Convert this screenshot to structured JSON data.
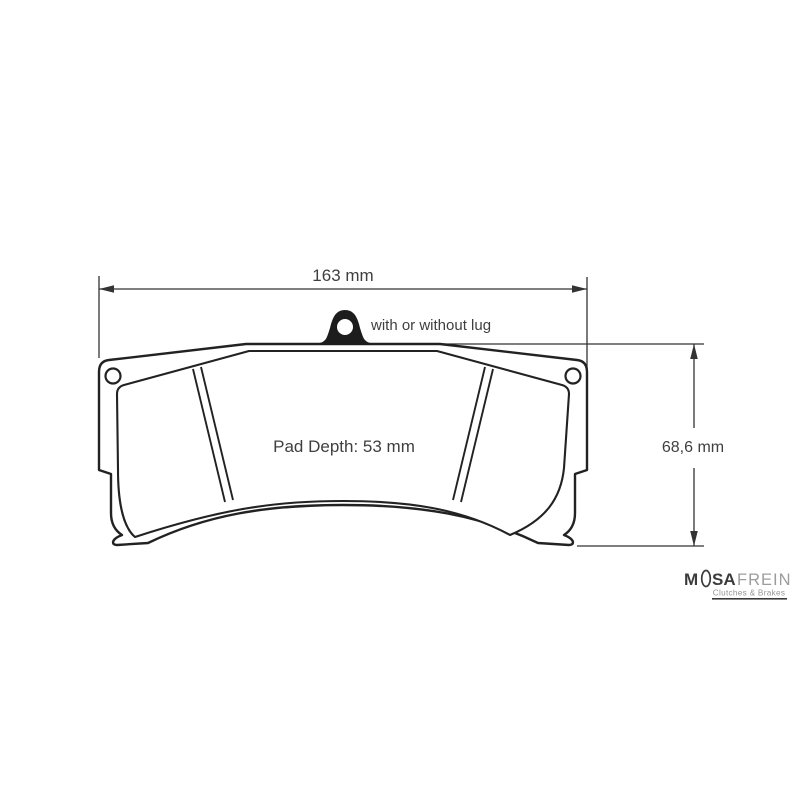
{
  "annotations": {
    "width_label": "163 mm",
    "height_label": "68,6 mm",
    "pad_depth_label": "Pad Depth: 53 mm",
    "lug_note": "with or without lug"
  },
  "logo": {
    "brand_prefix": "M",
    "brand_suffix": "SA",
    "brand_secondary": "FREIN",
    "tagline": "Clutches & Brakes"
  },
  "colors": {
    "outline": "#222222",
    "dimension_line": "#333333",
    "label_text": "#3f3f3f",
    "logo_dark": "#3b3b3b",
    "logo_gray": "#9c9c9c"
  }
}
